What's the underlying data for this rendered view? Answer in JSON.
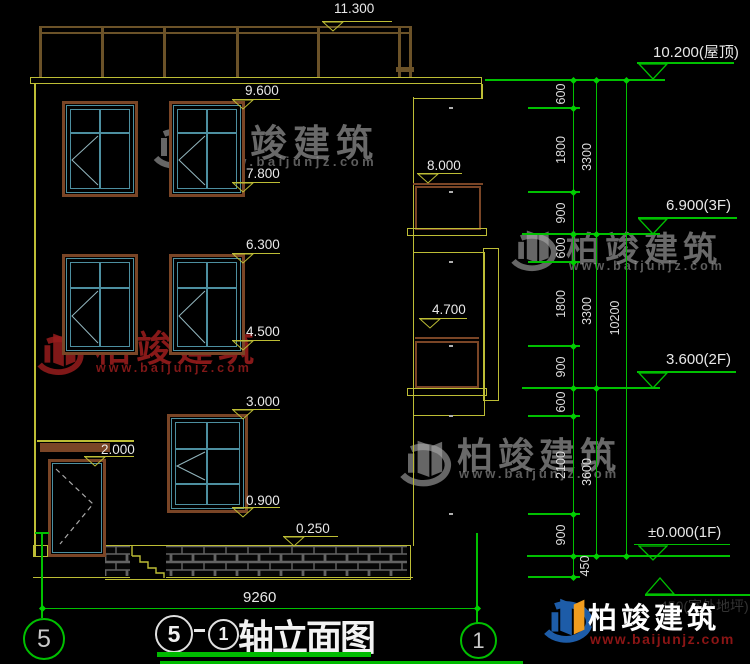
{
  "facade_marks": {
    "parapet": "11.300",
    "w3_top": "9.600",
    "w3_sill": "7.800",
    "balcony3": "8.000",
    "w2_top": "6.300",
    "w2_sill": "4.500",
    "bay2": "4.700",
    "w1_top": "3.000",
    "canopy": "2.000",
    "w1_sill": "0.900",
    "plinth": "0.250"
  },
  "elevation_marks": {
    "roof": "10.200(屋顶)",
    "f3": "6.900(3F)",
    "f2": "3.600(2F)",
    "f1": "±0.000(1F)",
    "outdoor_partial": "450(室外地坪)"
  },
  "dims": {
    "overall_width": "9260",
    "col_a": [
      "600",
      "1800",
      "900",
      "600",
      "1800",
      "900",
      "600",
      "2100",
      "900",
      "450"
    ],
    "col_b": [
      "3300",
      "3300",
      "3600"
    ],
    "col_c": [
      "10200"
    ]
  },
  "grid": {
    "left": "5",
    "right": "1"
  },
  "title_block": {
    "axis_start": "5",
    "separator": "-",
    "axis_end": "1",
    "title": "轴立面图"
  },
  "watermark": {
    "brand": "柏竣建筑",
    "url": "www.baijunjz.com"
  }
}
